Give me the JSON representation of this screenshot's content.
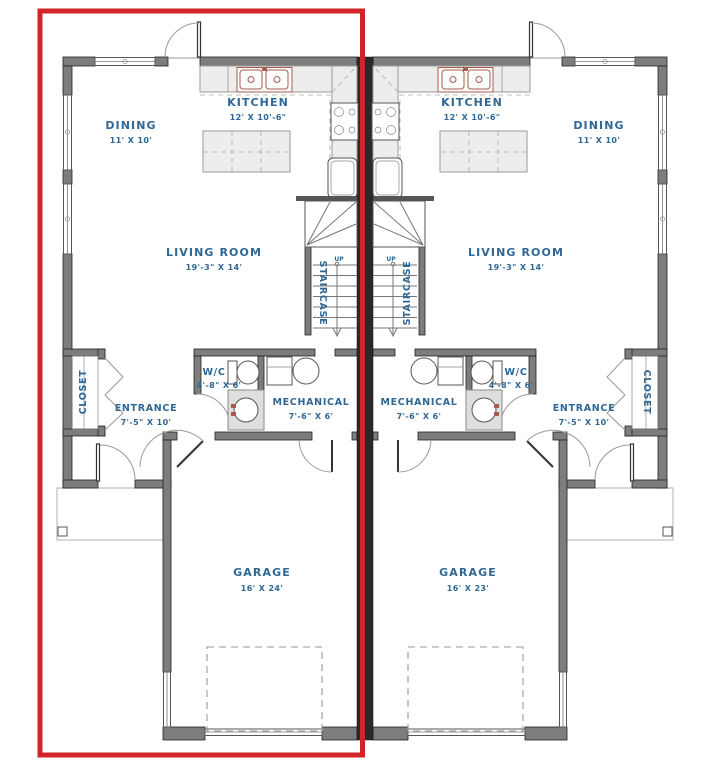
{
  "colors": {
    "highlight": "#d02528",
    "label": "#2f6795",
    "wall": "#7d7d7d",
    "party_wall": "#2a2a2a",
    "counter": "#ededeb",
    "fixture_outline": "#555555",
    "sink_accent": "#a85c50"
  },
  "units": [
    {
      "side": "left",
      "kitchen": {
        "name": "KITCHEN",
        "dims": "12' X 10'-6\""
      },
      "dining": {
        "name": "DINING",
        "dims": "11' X 10'"
      },
      "living_room": {
        "name": "LIVING ROOM",
        "dims": "19'-3\" X 14'"
      },
      "staircase": {
        "name": "STAIRCASE",
        "direction": "UP"
      },
      "wc": {
        "name": "W/C",
        "dims": "4'-8\" X 6'"
      },
      "mechanical": {
        "name": "MECHANICAL",
        "dims": "7'-6\" X 6'"
      },
      "entrance": {
        "name": "ENTRANCE",
        "dims": "7'-5\" X 10'"
      },
      "closet": {
        "name": "CLOSET"
      },
      "garage": {
        "name": "GARAGE",
        "dims": "16' X 24'"
      }
    },
    {
      "side": "right",
      "kitchen": {
        "name": "KITCHEN",
        "dims": "12' X 10'-6\""
      },
      "dining": {
        "name": "DINING",
        "dims": "11' X 10'"
      },
      "living_room": {
        "name": "LIVING ROOM",
        "dims": "19'-3\" X 14'"
      },
      "staircase": {
        "name": "STAIRCASE",
        "direction": "UP"
      },
      "wc": {
        "name": "W/C",
        "dims": "4'-8\" X 6'"
      },
      "mechanical": {
        "name": "MECHANICAL",
        "dims": "7'-6\" X 6'"
      },
      "entrance": {
        "name": "ENTRANCE",
        "dims": "7'-5\" X 10'"
      },
      "closet": {
        "name": "CLOSET"
      },
      "garage": {
        "name": "GARAGE",
        "dims": "16' X 23'"
      }
    }
  ]
}
